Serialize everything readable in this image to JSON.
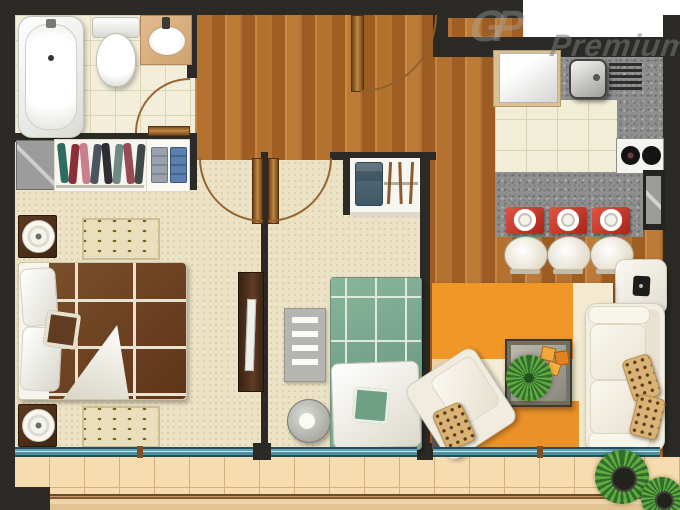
{
  "meta": {
    "image_type": "apartment floor plan, top-down 3D render",
    "rooms_count": "2 bedrooms + bathroom + kitchen + living room + balcony"
  },
  "watermark": {
    "logo": "GP",
    "label": "Premium"
  },
  "palette": {
    "wall": "#2b2a26",
    "wood_floor": "#b5722f",
    "bedroom_carpet": "#ece2c5",
    "bath_tile": "#f3eed9",
    "kitchen_tile": "#f2edd6",
    "balcony_tile": "#f6dcae",
    "counter_granite": "#8f8f8f",
    "window_glass": "#5da5b4",
    "placemat_red": "#cc392a",
    "master_bed": "#6f4526",
    "second_bed": "#7fab92",
    "living_rug_orange": "#f09727"
  },
  "rooms": {
    "bathroom": {
      "fixtures": [
        "bathtub",
        "toilet",
        "sink-vanity",
        "swing-door"
      ]
    },
    "master_bedroom": {
      "furniture": [
        "gray-cabinet",
        "hanging-clothes-rail",
        "folded-clothes-shelf",
        "double-bed-brown",
        "nightstand-with-lamp-top",
        "nightstand-with-lamp-bottom",
        "dotted-rug-top",
        "dotted-rug-bottom",
        "swing-door"
      ]
    },
    "second_bedroom": {
      "furniture": [
        "closet-jeans-and-hangers",
        "desk",
        "striped-gray-rug",
        "round-stool",
        "single-bed-green",
        "swing-door"
      ]
    },
    "hallway_entry": {
      "features": [
        "entry-swing-door",
        "wood-floor"
      ]
    },
    "kitchen": {
      "items": [
        "refrigerator",
        "sink",
        "drainboard",
        "two-burner-cooktop",
        "tall-appliance",
        "breakfast-bar",
        "red-placemats-x3",
        "white-stools-x3"
      ]
    },
    "living_room": {
      "furniture": [
        "wall-tv",
        "color-block-area-rug",
        "glass-coffee-table",
        "table-plant",
        "orange-coasters-x3",
        "white-sofa",
        "white-armchair",
        "leopard-pillows-x3"
      ]
    },
    "balcony": {
      "features": [
        "sliding-glass-windows",
        "tile-floor",
        "railing",
        "palm-plant-large",
        "palm-plant-small"
      ]
    }
  }
}
